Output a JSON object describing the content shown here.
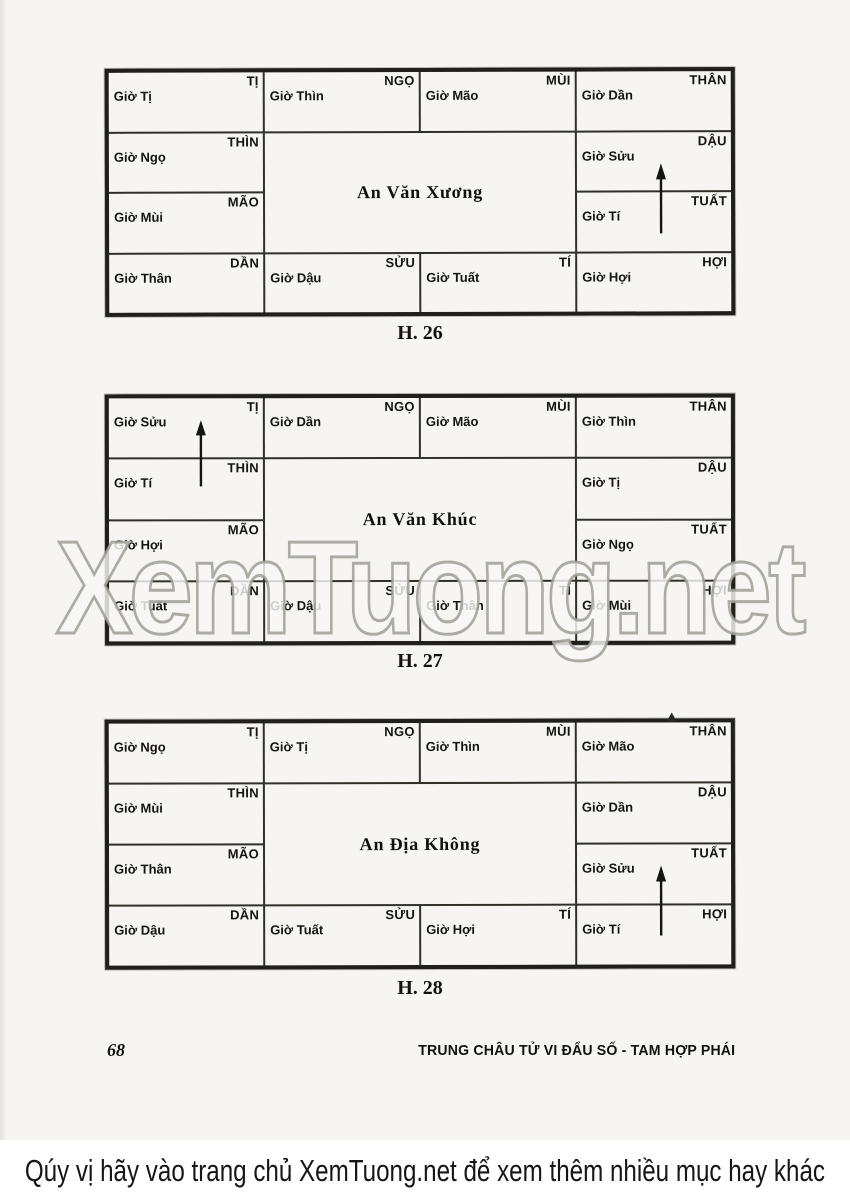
{
  "page": {
    "watermark": "XemTuong.net",
    "page_number": "68",
    "running_title": "TRUNG CHÂU TỬ VI ĐẨU SỐ - TAM HỢP PHÁI",
    "banner_text": "Qúy vị hãy vào trang chủ XemTuong.net để xem thêm nhiều mục hay khác",
    "colors": {
      "paper": "#f6f5f2",
      "ink": "#17140f",
      "grid_line": "#332e28",
      "watermark_outline": "#a09d97",
      "banner_background": "#ffffff"
    }
  },
  "charts": [
    {
      "caption": "H. 26",
      "title": "An Văn Xương",
      "arrow": {
        "direction": "up",
        "location": "right column, spanning DẬU and TUẤT cells"
      },
      "cells": [
        {
          "branch": "TỊ",
          "hour": "Giờ Tị"
        },
        {
          "branch": "NGỌ",
          "hour": "Giờ Thìn"
        },
        {
          "branch": "MÙI",
          "hour": "Giờ Mão"
        },
        {
          "branch": "THÂN",
          "hour": "Giờ Dần"
        },
        {
          "branch": "THÌN",
          "hour": "Giờ Ngọ"
        },
        {
          "branch": "DẬU",
          "hour": "Giờ Sửu"
        },
        {
          "branch": "MÃO",
          "hour": "Giờ Mùi"
        },
        {
          "branch": "TUẤT",
          "hour": "Giờ Tí"
        },
        {
          "branch": "DẦN",
          "hour": "Giờ Thân"
        },
        {
          "branch": "SỬU",
          "hour": "Giờ Dậu"
        },
        {
          "branch": "TÍ",
          "hour": "Giờ Tuất"
        },
        {
          "branch": "HỢI",
          "hour": "Giờ Hợi"
        }
      ]
    },
    {
      "caption": "H. 27",
      "title": "An Văn Khúc",
      "arrow": {
        "direction": "up",
        "location": "left column, spanning TỊ and THÌN cells"
      },
      "cells": [
        {
          "branch": "TỊ",
          "hour": "Giờ Sửu"
        },
        {
          "branch": "NGỌ",
          "hour": "Giờ Dần"
        },
        {
          "branch": "MÙI",
          "hour": "Giờ Mão"
        },
        {
          "branch": "THÂN",
          "hour": "Giờ Thìn"
        },
        {
          "branch": "THÌN",
          "hour": "Giờ Tí"
        },
        {
          "branch": "DẬU",
          "hour": "Giờ Tị"
        },
        {
          "branch": "MÃO",
          "hour": "Giờ Hợi"
        },
        {
          "branch": "TUẤT",
          "hour": "Giờ Ngọ"
        },
        {
          "branch": "DẦN",
          "hour": "Giờ Tuất"
        },
        {
          "branch": "SỬU",
          "hour": "Giờ Dậu"
        },
        {
          "branch": "TÍ",
          "hour": "Giờ Thân"
        },
        {
          "branch": "HỢI",
          "hour": "Giờ Mùi"
        }
      ]
    },
    {
      "caption": "H. 28",
      "title": "An Địa Không",
      "arrow": {
        "direction": "up",
        "location": "right column, spanning TUẤT and HỢI cells"
      },
      "cells": [
        {
          "branch": "TỊ",
          "hour": "Giờ Ngọ"
        },
        {
          "branch": "NGỌ",
          "hour": "Giờ Tị"
        },
        {
          "branch": "MÙI",
          "hour": "Giờ Thìn"
        },
        {
          "branch": "THÂN",
          "hour": "Giờ Mão"
        },
        {
          "branch": "THÌN",
          "hour": "Giờ Mùi"
        },
        {
          "branch": "DẬU",
          "hour": "Giờ Dần"
        },
        {
          "branch": "MÃO",
          "hour": "Giờ Thân"
        },
        {
          "branch": "TUẤT",
          "hour": "Giờ Sửu"
        },
        {
          "branch": "DẦN",
          "hour": "Giờ Dậu"
        },
        {
          "branch": "SỬU",
          "hour": "Giờ Tuất"
        },
        {
          "branch": "TÍ",
          "hour": "Giờ Hợi"
        },
        {
          "branch": "HỢI",
          "hour": "Giờ Tí"
        }
      ]
    }
  ]
}
